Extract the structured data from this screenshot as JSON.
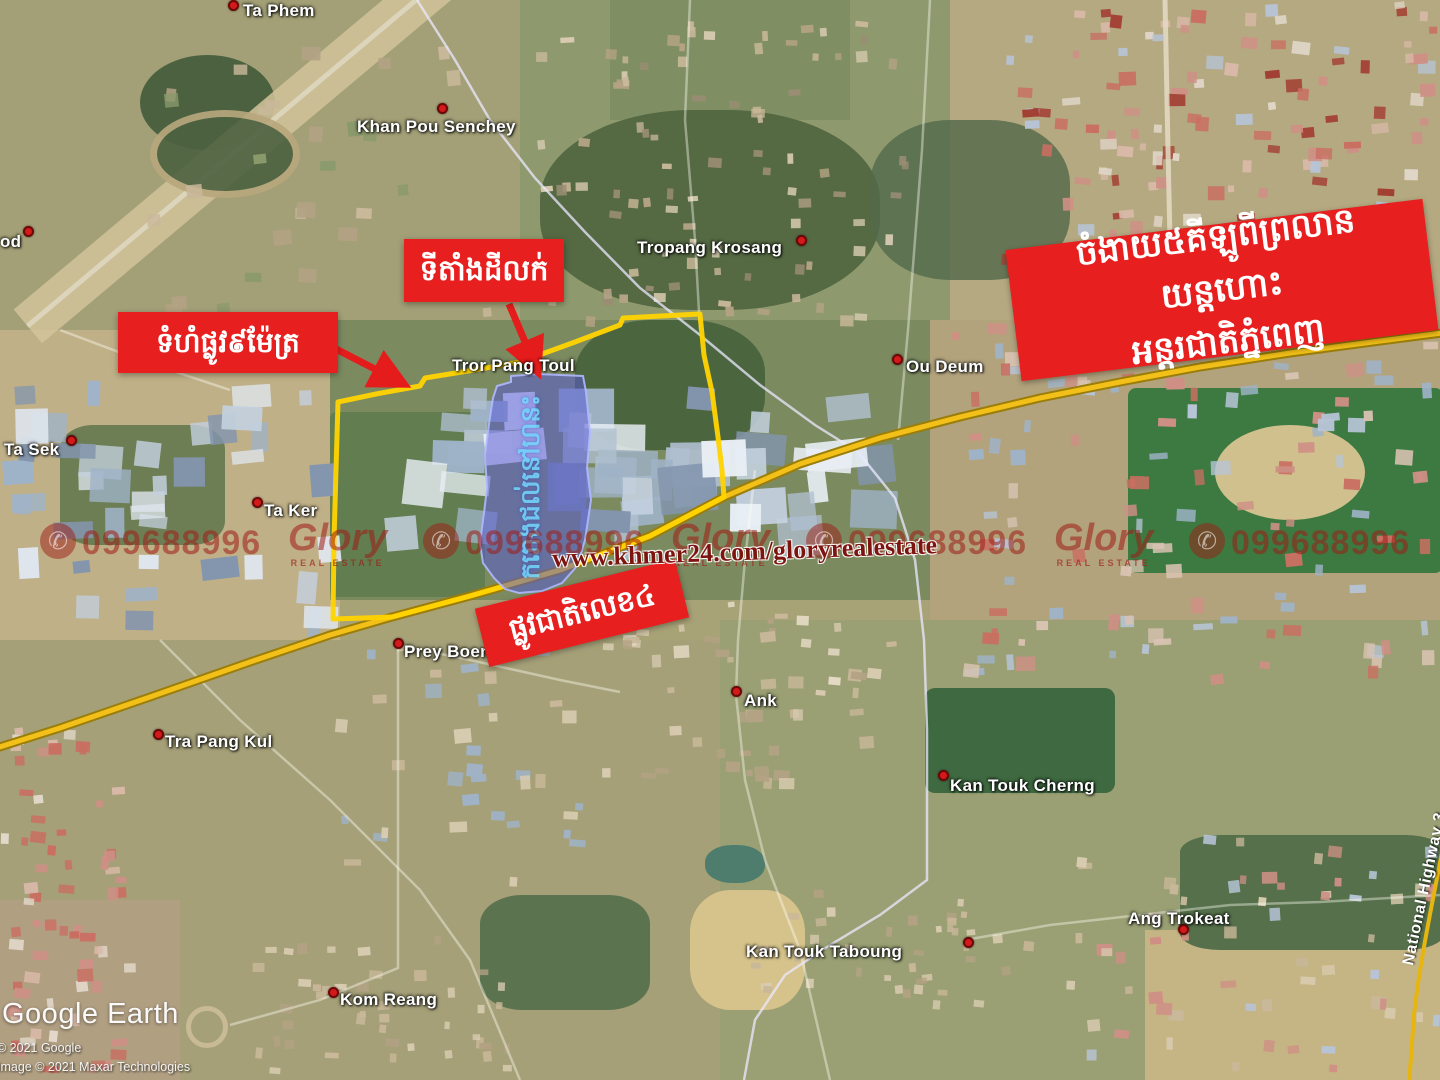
{
  "banner": {
    "line1": "ចំងាយ៥គីឡូពីព្រលានយន្តហោះ",
    "line2": "អន្តរជាតិភ្នំពេញ"
  },
  "callouts": {
    "site": "ទីតាំងដីលក់",
    "road_width": "ទំហំផ្លូវ៩ម៉ែត្រ",
    "national_road": "ផ្លូវជាតិលេខ៤"
  },
  "route_shield": "4",
  "highway3_label": "National Highway 3",
  "parcel_watermark": "ករោងជល់នៅហនះ",
  "watermark": {
    "url": "www.khmer24.com/gloryrealestate",
    "phone": "099688996",
    "brand": "Glory",
    "brand_sub": "REAL ESTATE"
  },
  "places": [
    {
      "name": "Ta Phem"
    },
    {
      "name": "Khan Pou Senchey"
    },
    {
      "name": "Tropang Krosang"
    },
    {
      "name": "Tror Pang Toul"
    },
    {
      "name": "Ou Deum"
    },
    {
      "name": "Ta Sek"
    },
    {
      "name": "Ta Ker"
    },
    {
      "name": "Prey Boeng"
    },
    {
      "name": "Tra Pang Kul"
    },
    {
      "name": "Ank"
    },
    {
      "name": "Kan Touk Cherng"
    },
    {
      "name": "Kan Touk Taboung"
    },
    {
      "name": "Ang Trokeat"
    },
    {
      "name": "Kom Reang"
    },
    {
      "name": "od"
    }
  ],
  "attribution": {
    "logo": "Google Earth",
    "copyright1": "© 2021 Google",
    "copyright2": "Image © 2021 Maxar Technologies"
  },
  "colors": {
    "annotation_red": "#e81f1f",
    "boundary_yellow": "#ffd400",
    "road_yellow": "#f2c018",
    "parcel_blue": "#5a5ed8",
    "watermark_red": "#a93226",
    "shield_blue": "#3f63c0"
  }
}
